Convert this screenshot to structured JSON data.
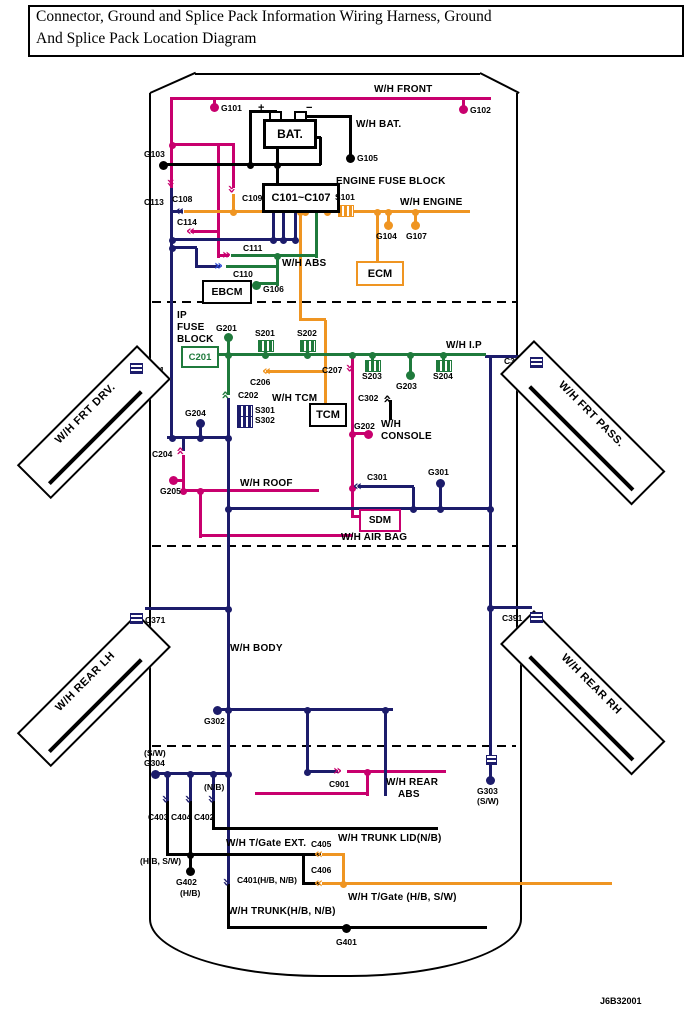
{
  "title": {
    "line1": "Connector, Ground and Splice Pack Information Wiring Harness, Ground",
    "line2": "And Splice Pack Location Diagram"
  },
  "doc_number": "J6B32001",
  "colors": {
    "magenta": "#C8006E",
    "navy": "#1C1C6B",
    "orange": "#EF9522",
    "green": "#1F7A3C",
    "black": "#000000",
    "blue": "#2D4BD4"
  },
  "harnesses": {
    "front": "W/H FRONT",
    "bat": "W/H BAT.",
    "engine": "W/H ENGINE",
    "abs": "W/H ABS",
    "ip": "W/H I.P",
    "tcm": "W/H TCM",
    "console_line1": "W/H",
    "console_line2": "CONSOLE",
    "roof": "W/H ROOF",
    "air_bag": "W/H AIR BAG",
    "frt_drv": "W/H FRT DRV.",
    "frt_pass": "W/H FRT PASS.",
    "rear_lh": "W/H REAR LH",
    "rear_rh": "W/H REAR RH",
    "body": "W/H BODY",
    "rear_abs_line1": "W/H REAR",
    "rear_abs_line2": "ABS",
    "tgate_ext": "W/H T/Gate EXT.",
    "trunk_lid": "W/H TRUNK LID(N/B)",
    "tgate": "W/H T/Gate (H/B, S/W)",
    "trunk": "W/H TRUNK(H/B, N/B)"
  },
  "blocks": {
    "engine_fuse_label": "ENGINE FUSE BLOCK",
    "engine_fuse_connectors": "C101~C107",
    "bat": "BAT.",
    "bat_plus": "+",
    "bat_minus": "−",
    "ecm": "ECM",
    "ebcm": "EBCM",
    "ip_fuse_line1": "IP",
    "ip_fuse_line2": "FUSE",
    "ip_fuse_line3": "BLOCK",
    "c201": "C201",
    "tcm": "TCM",
    "sdm": "SDM"
  },
  "grounds": {
    "g101": "G101",
    "g102": "G102",
    "g103": "G103",
    "g104": "G104",
    "g105": "G105",
    "g106": "G106",
    "g107": "G107",
    "g201": "G201",
    "g202": "G202",
    "g203": "G203",
    "g204": "G204",
    "g205": "G205",
    "g301": "G301",
    "g302": "G302",
    "g303": "G303",
    "g303_note": "(S/W)",
    "g304": "G304",
    "g304_note": "(S/W)",
    "g401": "G401",
    "g402": "G402",
    "g402_note": "(H/B)"
  },
  "connectors": {
    "c108": "C108",
    "c109": "C109",
    "c110": "C110",
    "c111": "C111",
    "c113": "C113",
    "c114": "C114",
    "c202": "C202",
    "c204": "C204",
    "c206": "C206",
    "c207": "C207",
    "c301": "C301",
    "c302": "C302",
    "c361": "C361",
    "c371": "C371",
    "c381": "C381",
    "c391": "C391",
    "c401": "C401(H/B, N/B)",
    "c402": "C402",
    "c402_note": "(N/B)",
    "c403": "C403",
    "c404": "C404",
    "c405": "C405",
    "c406": "C406",
    "c901": "C901",
    "tgate_ext_note": "(H/B, S/W)"
  },
  "splices": {
    "s101": "S101",
    "s201": "S201",
    "s202": "S202",
    "s203": "S203",
    "s204": "S204",
    "s301": "S301",
    "s302": "S302"
  }
}
